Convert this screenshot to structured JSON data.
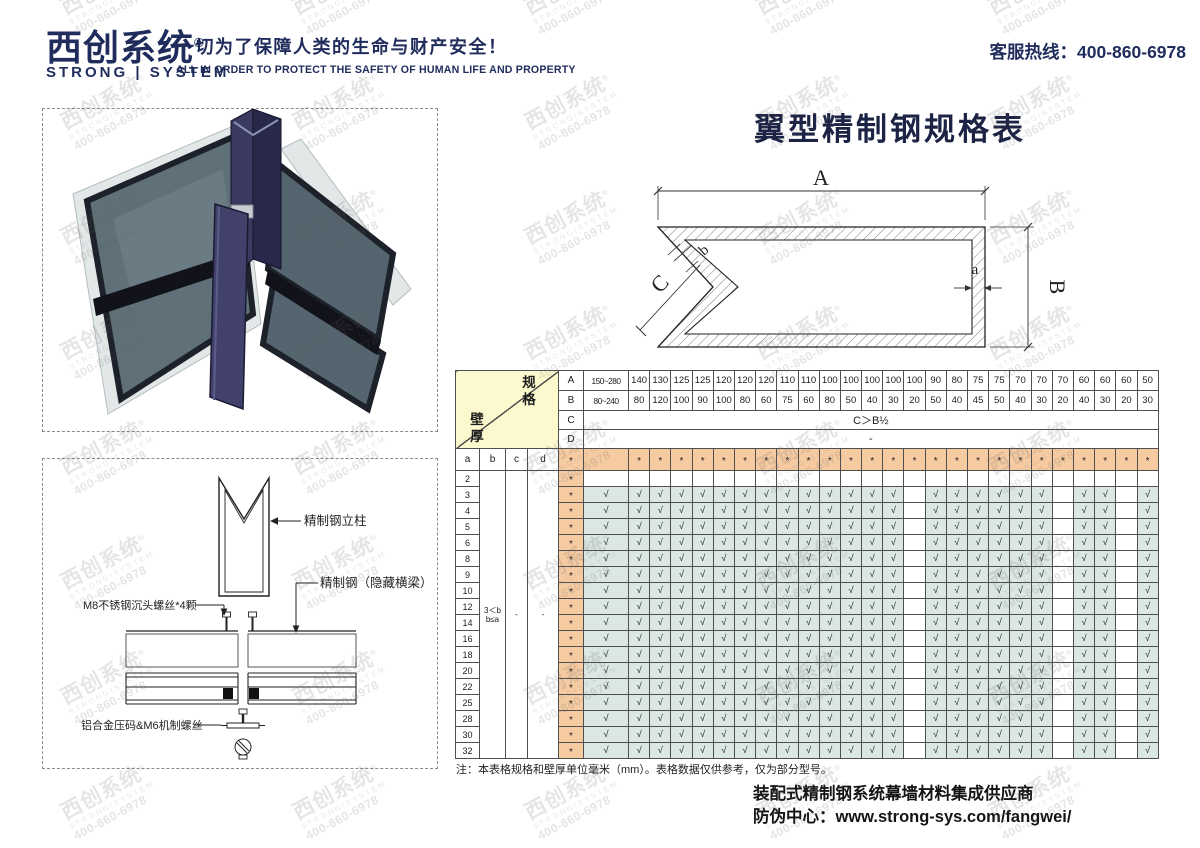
{
  "header": {
    "logo_cn": "西创系统",
    "logo_reg": "®",
    "logo_en": "STRONG | SYSTEM",
    "slogan_cn": "一切为了保障人类的生命与财产安全！",
    "slogan_en": "ALL IN ORDER TO PROTECT THE SAFETY OF HUMAN LIFE AND PROPERTY",
    "hotline": "客服热线：400-860-6978"
  },
  "watermark": {
    "cn": "西创系统",
    "reg": "®",
    "en": "STRONGISYSTEM",
    "tel": "400-860-6978"
  },
  "main_title": "翼型精制钢规格表",
  "profile_diagram": {
    "labels": {
      "A": "A",
      "B": "B",
      "C": "C",
      "a": "a",
      "b": "b"
    }
  },
  "illustration_labels": {
    "mullion": "精制钢立柱",
    "beam": "精制钢（隐藏横梁）",
    "screw": "M8不锈钢沉头螺丝*4颗",
    "clamp": "铝合金压码&M6机制螺丝"
  },
  "spec_table": {
    "corner": {
      "top_right": "规格",
      "bottom_left": "壁厚"
    },
    "row_labels": [
      "A",
      "B",
      "C",
      "D"
    ],
    "columns": {
      "A": [
        "150~280",
        "140",
        "130",
        "125",
        "125",
        "120",
        "120",
        "120",
        "110",
        "110",
        "100",
        "100",
        "100",
        "100",
        "100",
        "90",
        "80",
        "75",
        "75",
        "70",
        "70",
        "70",
        "60",
        "60",
        "60",
        "50"
      ],
      "B": [
        "80~240",
        "80",
        "120",
        "100",
        "90",
        "100",
        "80",
        "60",
        "75",
        "60",
        "80",
        "50",
        "40",
        "30",
        "20",
        "50",
        "40",
        "45",
        "50",
        "40",
        "30",
        "20",
        "40",
        "30",
        "20",
        "30"
      ]
    },
    "c_row_value": "C＞B½",
    "d_row_value": "-",
    "thickness_headers": [
      "a",
      "b",
      "c",
      "d"
    ],
    "a_values": [
      "2",
      "3",
      "4",
      "5",
      "6",
      "8",
      "9",
      "10",
      "12",
      "14",
      "16",
      "18",
      "20",
      "22",
      "25",
      "28",
      "30",
      "32"
    ],
    "b_constraint": [
      "3＜b",
      "b≤a"
    ],
    "c_constraint": "-",
    "d_constraint": "-",
    "marker": "*",
    "check": "√",
    "excluded_b": "20"
  },
  "note": "注：本表格规格和壁厚单位毫米（mm）。表格数据仅供参考，仅为部分型号。",
  "footer": {
    "line1": "装配式精制钢系统幕墙材料集成供应商",
    "line2": "防伪中心：www.strong-sys.com/fangwei/"
  },
  "colors": {
    "navy": "#1f2c5c",
    "orange": "#f6cba2",
    "teal": "#dbe8e2",
    "corner_yellow": "#fdf9cf",
    "border": "#4f4f4f"
  }
}
